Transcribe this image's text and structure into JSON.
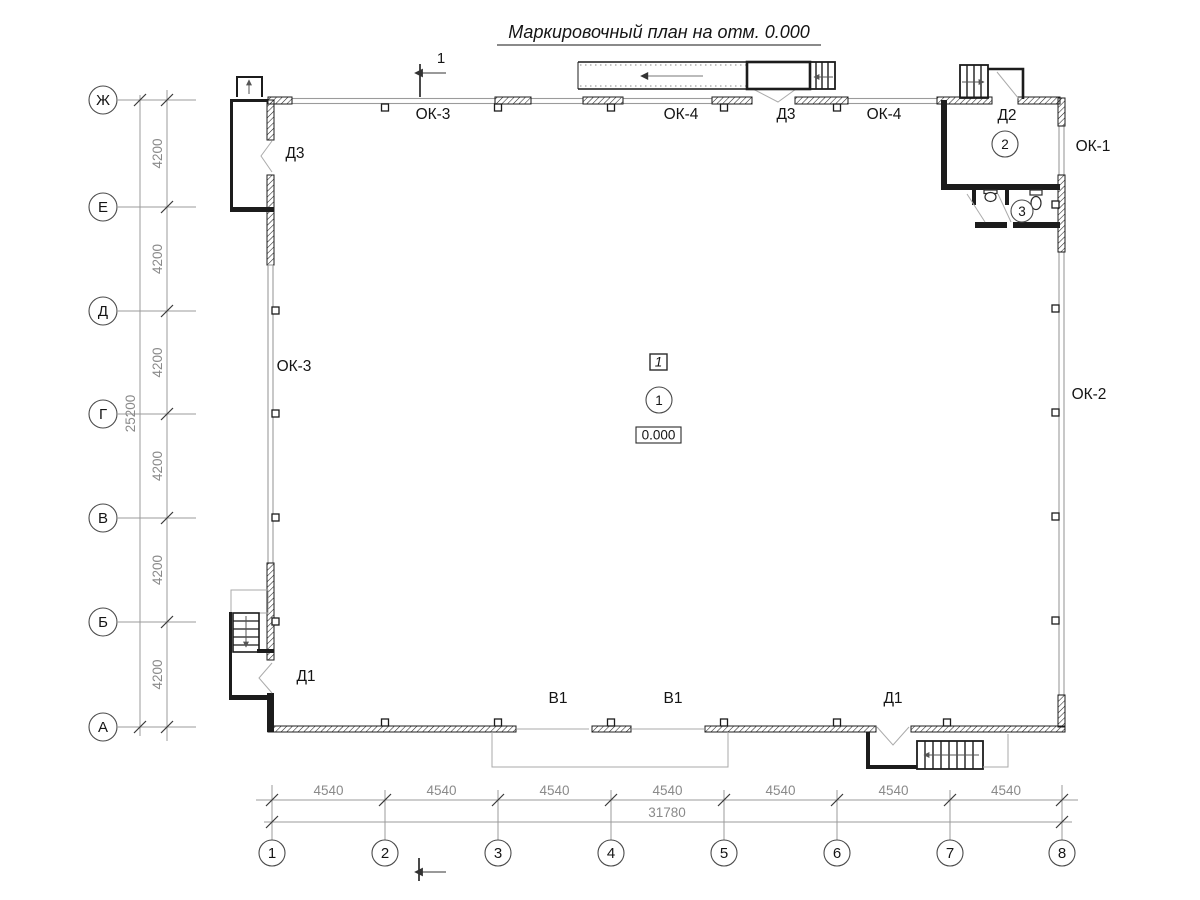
{
  "title": "Маркировочный план на отм. 0.000",
  "colors": {
    "line": "#1c1c1c",
    "secondary": "#9b9b9b",
    "dim_text": "#8a8a8a",
    "background": "#ffffff"
  },
  "axes": {
    "rows": [
      "Ж",
      "Е",
      "Д",
      "Г",
      "В",
      "Б",
      "А"
    ],
    "cols": [
      "1",
      "2",
      "3",
      "4",
      "5",
      "6",
      "7",
      "8"
    ]
  },
  "dims": {
    "row_step": "4200",
    "row_total": "25200",
    "col_step": "4540",
    "col_total": "31780"
  },
  "section": {
    "label": "1"
  },
  "marks": {
    "ok3_top": "ОК-3",
    "ok4_left": "ОК-4",
    "d3_top": "Д3",
    "ok4_right": "ОК-4",
    "d2": "Д2",
    "ok1": "ОК-1",
    "ok2": "ОК-2",
    "ok3_left": "ОК-3",
    "d3_left": "Д3",
    "d1_left": "Д1",
    "v1_left": "В1",
    "v1_right": "В1",
    "d1_right": "Д1"
  },
  "markers": {
    "position": "1",
    "room_hall": "1",
    "elevation": "0.000",
    "room_vestibule": "2",
    "room_wc": "3"
  }
}
